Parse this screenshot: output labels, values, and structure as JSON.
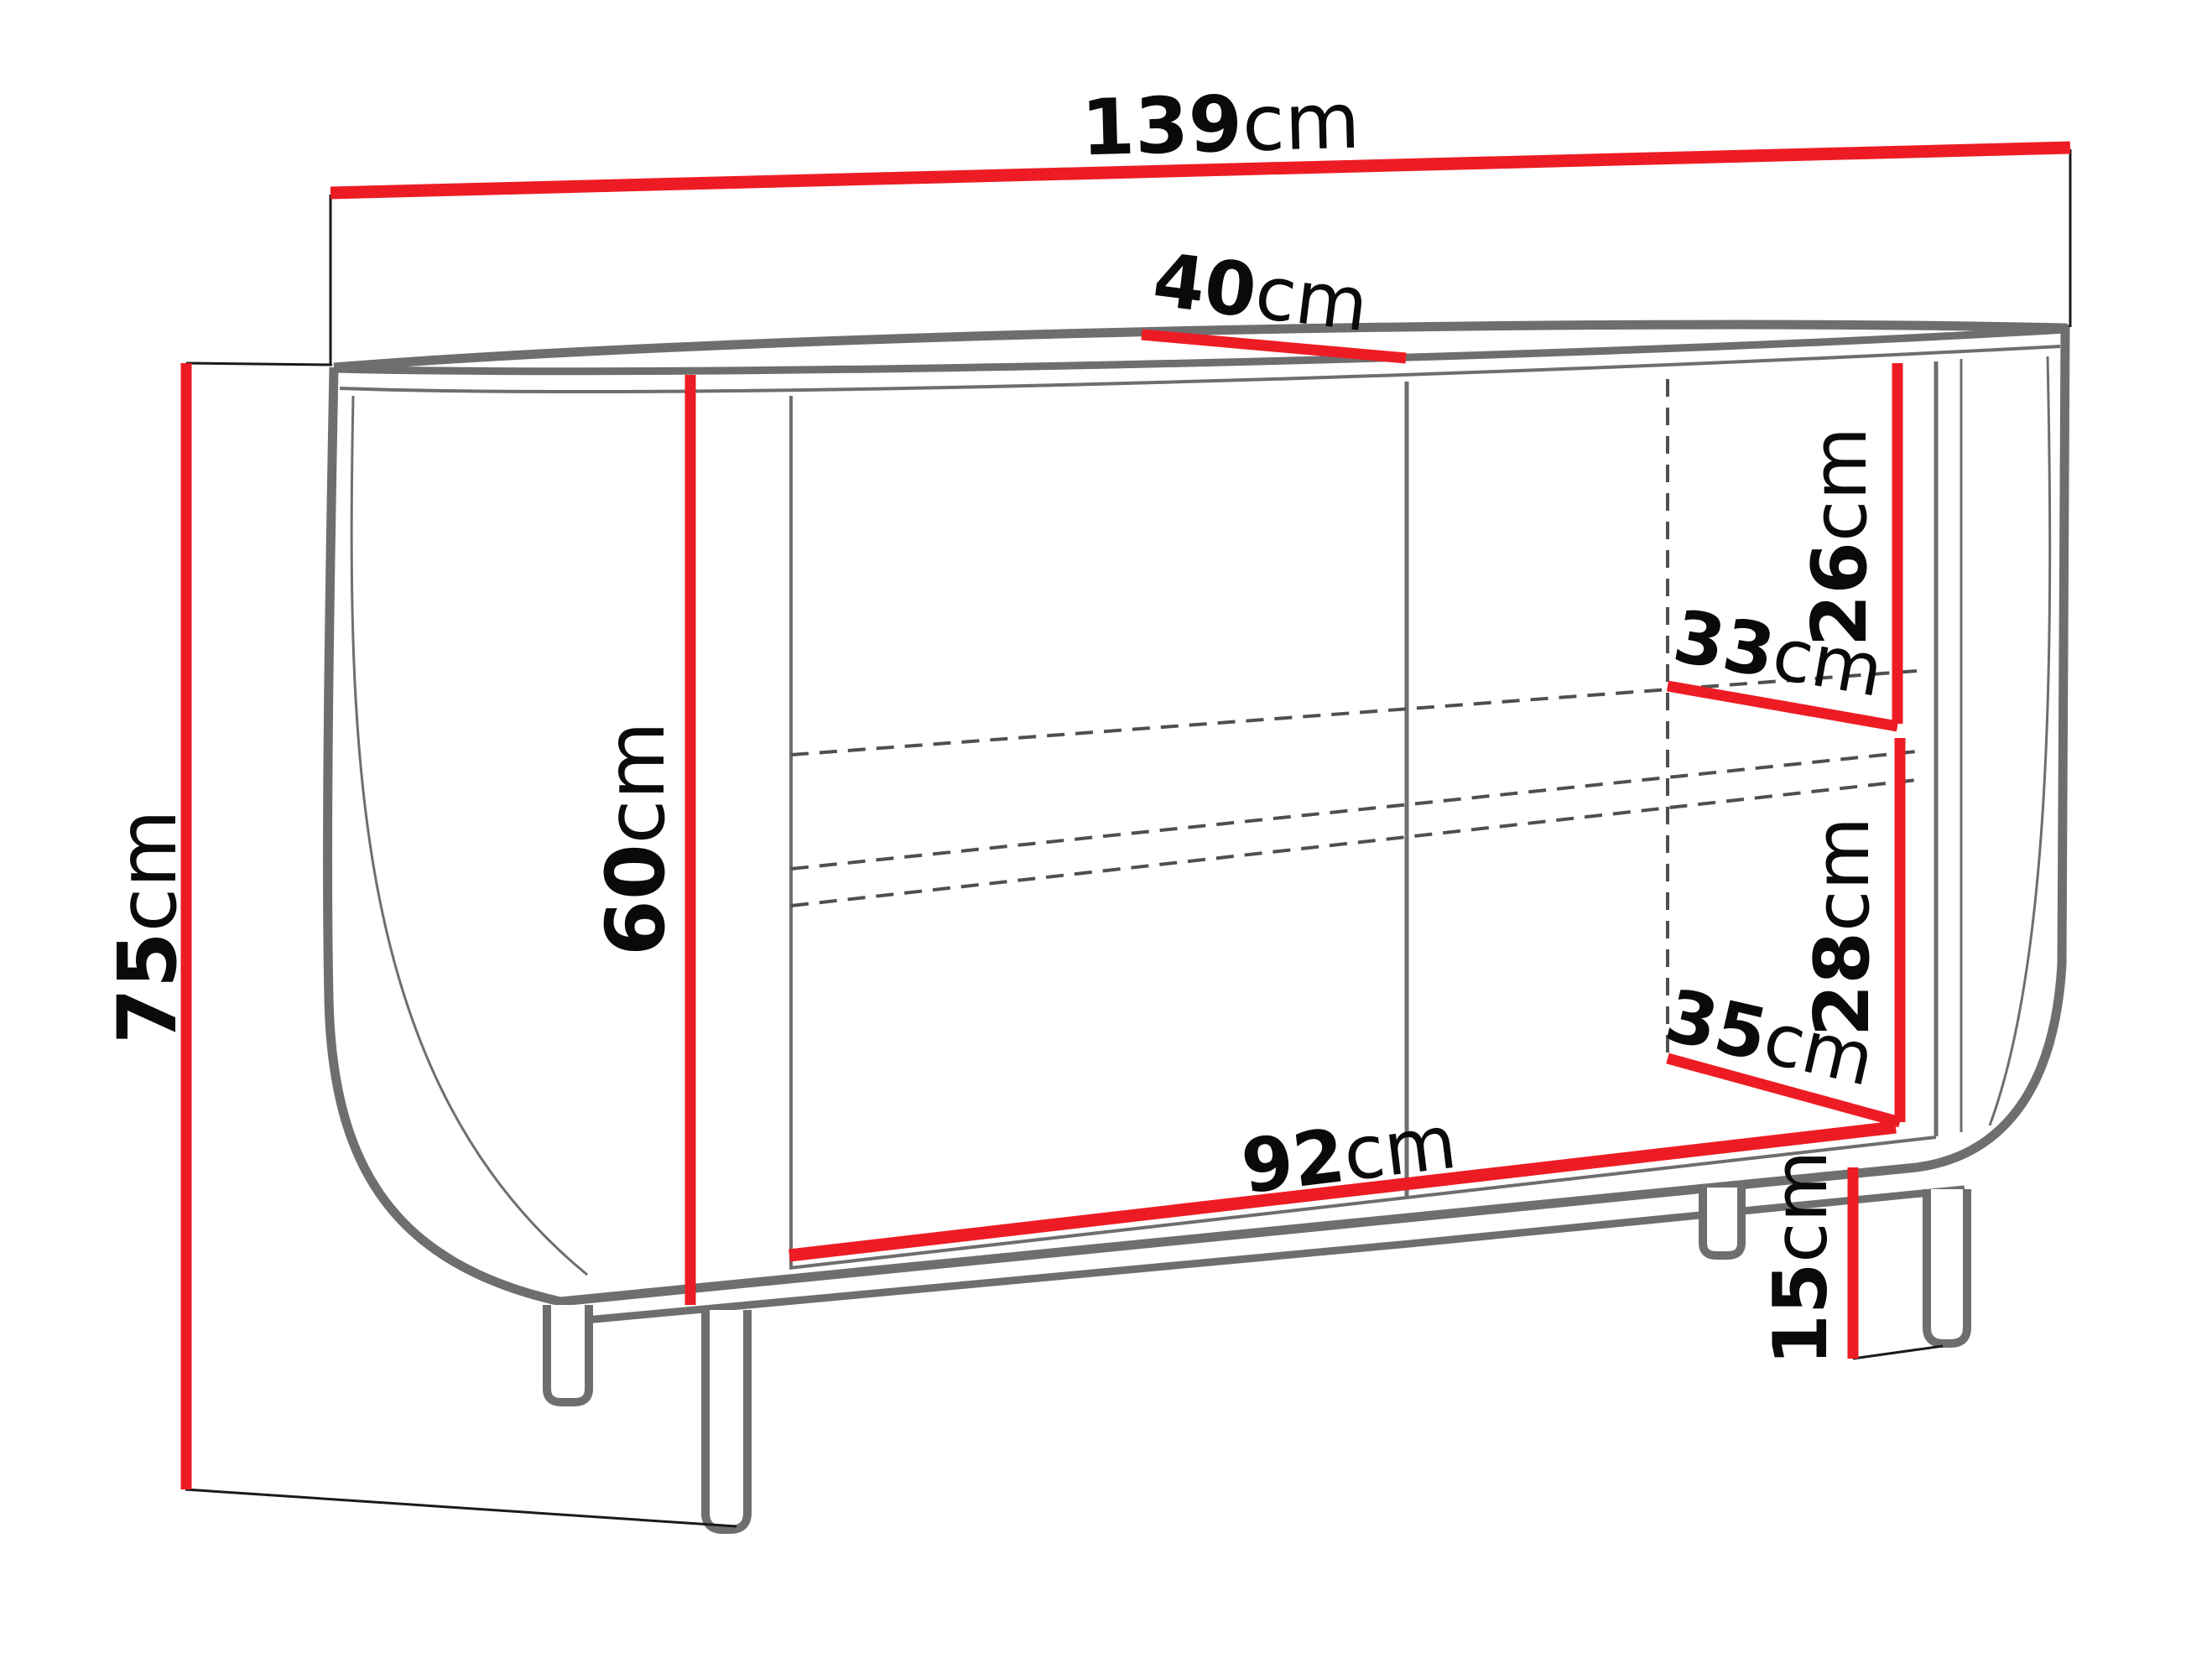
{
  "figure": {
    "kind": "furniture-dimension-diagram",
    "subject": "oval sideboard with two doors, open side niche and four legs, front perspective view",
    "background": "#ffffff"
  },
  "colors": {
    "dimension_line": "#ed1c24",
    "body_outline": "#6e6e6e",
    "hidden_line": "#4f4f4f",
    "extension_line": "#1a1a1a",
    "label_text": "#0a0a0a"
  },
  "dimensions": {
    "width": {
      "value": "139",
      "unit": "cm",
      "label": "139cm",
      "measures": "overall width"
    },
    "depth": {
      "value": "40",
      "unit": "cm",
      "label": "40cm",
      "measures": "overall depth (top)"
    },
    "height": {
      "value": "75",
      "unit": "cm",
      "label": "75cm",
      "measures": "overall height"
    },
    "body_height": {
      "value": "60",
      "unit": "cm",
      "label": "60cm",
      "measures": "carcass front height"
    },
    "niche_upper_height": {
      "value": "26",
      "unit": "cm",
      "label": "26cm",
      "measures": "upper niche height"
    },
    "niche_upper_depth": {
      "value": "33",
      "unit": "cm",
      "label": "33cm",
      "measures": "upper niche depth"
    },
    "niche_lower_height": {
      "value": "28",
      "unit": "cm",
      "label": "28cm",
      "measures": "lower niche height"
    },
    "niche_lower_depth": {
      "value": "35",
      "unit": "cm",
      "label": "35cm",
      "measures": "lower niche depth"
    },
    "interior_width": {
      "value": "92",
      "unit": "cm",
      "label": "92cm",
      "measures": "interior / door section width"
    },
    "leg_height": {
      "value": "15",
      "unit": "cm",
      "label": "15cm",
      "measures": "leg height"
    }
  }
}
